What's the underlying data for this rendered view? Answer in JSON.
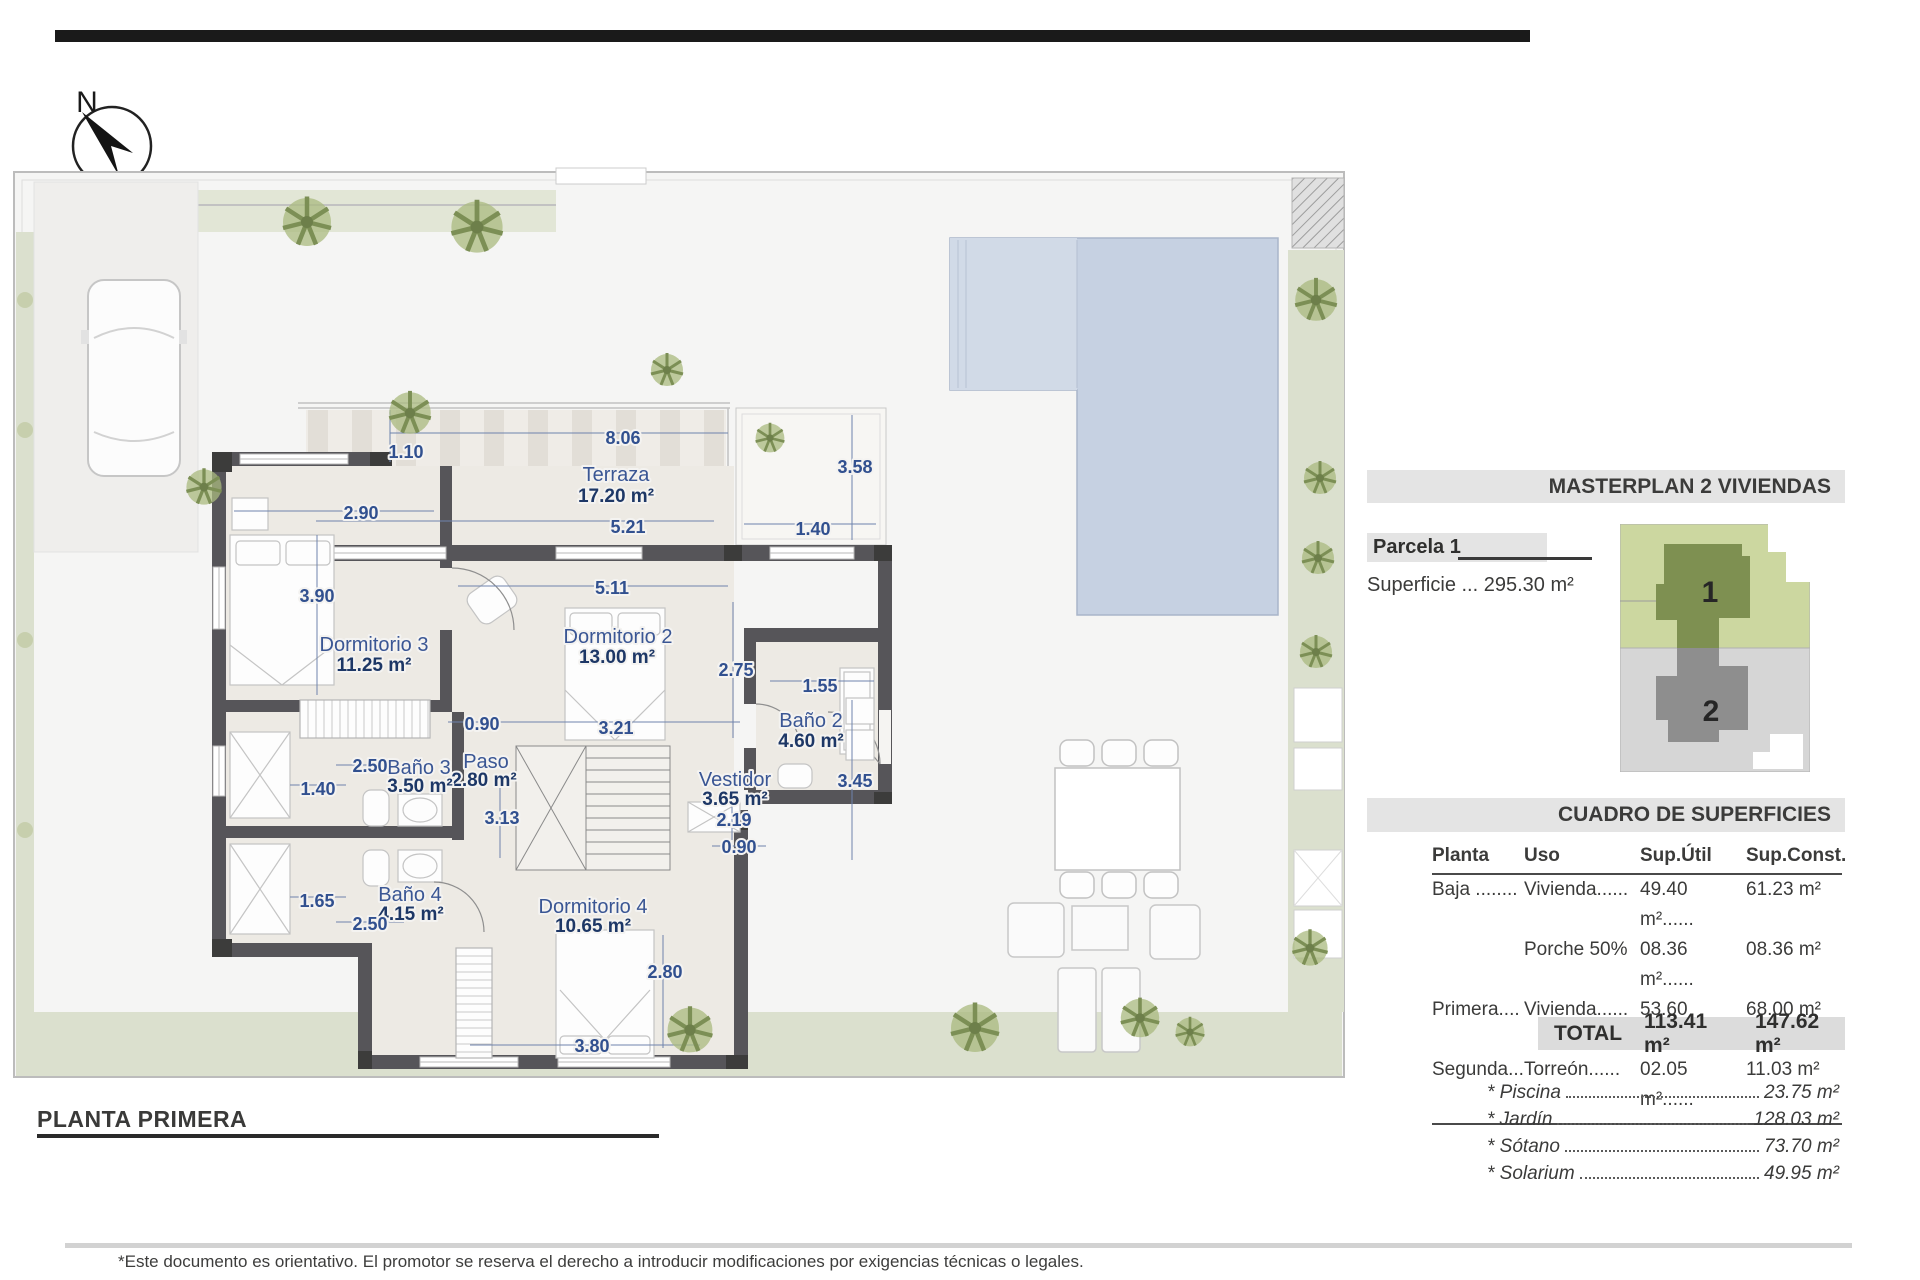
{
  "page": {
    "north_label": "N"
  },
  "plan": {
    "title": "PLANTA PRIMERA",
    "rooms": [
      {
        "name": "Terraza",
        "area": "17.20 m²"
      },
      {
        "name": "Dormitorio 3",
        "area": "11.25 m²"
      },
      {
        "name": "Dormitorio 2",
        "area": "13.00 m²"
      },
      {
        "name": "Baño 2",
        "area": "4.60 m²"
      },
      {
        "name": "Vestidor",
        "area": "3.65 m²"
      },
      {
        "name": "Paso",
        "area": "2.80 m²"
      },
      {
        "name": "Baño 3",
        "area": "3.50 m²"
      },
      {
        "name": "Baño 4",
        "area": "4.15 m²"
      },
      {
        "name": "Dormitorio 4",
        "area": "10.65 m²"
      }
    ],
    "dims": [
      "8.06",
      "1.10",
      "5.21",
      "1.40",
      "3.58",
      "2.90",
      "3.90",
      "5.11",
      "2.75",
      "1.55",
      "3.21",
      "0.90",
      "3.13",
      "2.50",
      "1.40",
      "1.65",
      "2.50",
      "0.90",
      "2.19",
      "3.45",
      "2.80",
      "3.80"
    ]
  },
  "panel": {
    "masterplan_title": "MASTERPLAN 2 VIVIENDAS",
    "parcela_label": "Parcela 1",
    "superficie": "Superficie ... 295.30 m²",
    "unit1": "1",
    "unit2": "2",
    "cuadro_title": "CUADRO DE SUPERFICIES",
    "table": {
      "headers": [
        "Planta",
        "Uso",
        "Sup.Útil",
        "Sup.Const."
      ],
      "rows": [
        [
          "Baja ........",
          "Vivienda......",
          "49.40 m²......",
          "61.23 m²"
        ],
        [
          "",
          "Porche 50%",
          "08.36 m²......",
          "08.36 m²"
        ],
        [
          "Primera....",
          "Vivienda......",
          "53.60 m²......",
          "68.00 m²"
        ],
        [
          "Segunda...",
          "Torreón......",
          "02.05 m²......",
          "11.03 m²"
        ]
      ],
      "total_label": "TOTAL",
      "total_util": "113.41 m²",
      "total_const": "147.62 m²"
    },
    "extras": [
      {
        "label": "* Piscina",
        "value": "23.75 m²"
      },
      {
        "label": "* Jardín",
        "value": "128.03 m²"
      },
      {
        "label": "* Sótano",
        "value": "73.70 m²"
      },
      {
        "label": "* Solarium",
        "value": "49.95 m²"
      }
    ]
  },
  "footer": {
    "disclaimer": "*Este documento es orientativo. El promotor se reserva el derecho a introducir modificaciones por exigencias técnicas o legales."
  },
  "colors": {
    "label_blue": "#3a5694",
    "dim_blue": "#31508f",
    "area_navy": "#1d3766",
    "wall_gray": "#565559",
    "pool_blue": "#c6d1e2",
    "garden_green": "#dbe0ce",
    "masterplan_green": "#ccd7a0",
    "masterplan_building1": "#7e9051",
    "masterplan_gray": "#d6d6d6",
    "masterplan_building2": "#8e8e8e",
    "bar_bg": "#e4e4e4"
  }
}
